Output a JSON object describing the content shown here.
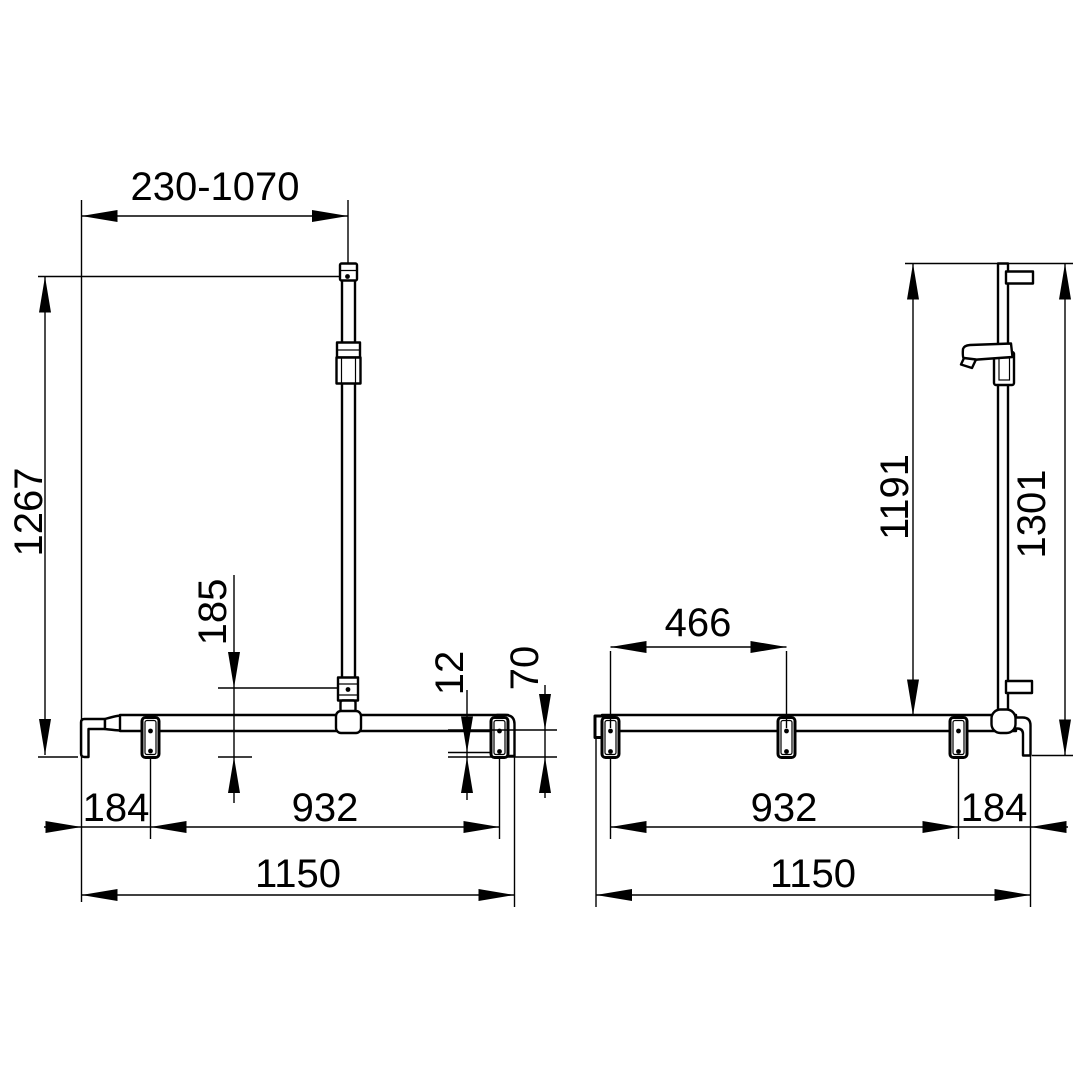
{
  "colors": {
    "background": "#ffffff",
    "line": "#000000"
  },
  "components": {
    "front_view": "front-view-shower-handrail",
    "side_view": "side-view-shower-handrail",
    "icons": [
      "hand-shower-icon",
      "wall-plate-icon",
      "slider-block-icon"
    ]
  },
  "front_view": {
    "adjust_range": "230-1070",
    "total_height": "1267",
    "lower_fixing_offset": "185",
    "plate_bottom_offset": "12",
    "end_drop": "70",
    "end_to_bracket": "184",
    "bracket_span": "932",
    "total_length": "1150"
  },
  "side_view": {
    "rail_height": "1191",
    "total_height": "1301",
    "upper_bracket_span": "466",
    "bracket_span": "932",
    "bracket_to_end": "184",
    "total_length": "1150"
  }
}
